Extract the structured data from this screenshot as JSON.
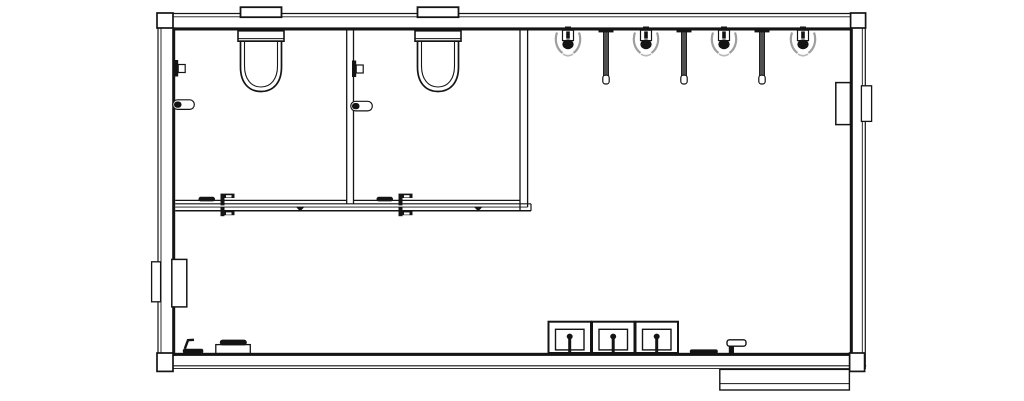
{
  "canvas": {
    "width": 1024,
    "height": 401,
    "background": "#ffffff",
    "ink": "#141414"
  },
  "layers": [
    {
      "name": "exterior-shell",
      "items": [
        {
          "name": "wall-top",
          "shapes": [
            {
              "t": "line",
              "x1": 157.2,
              "y1": 13.5,
              "x2": 866.2,
              "y2": 13.5,
              "sw": 1.2
            },
            {
              "t": "line",
              "x1": 158,
              "y1": 16.8,
              "x2": 865.4,
              "y2": 16.8,
              "sw": 0.9
            },
            {
              "t": "rect",
              "x": 173,
              "y": 27.4,
              "w": 677,
              "h": 3.1,
              "f": "#141414",
              "s": "none"
            }
          ]
        },
        {
          "name": "wall-bottom",
          "shapes": [
            {
              "t": "rect",
              "x": 173,
              "y": 352.8,
              "w": 677,
              "h": 3.1,
              "f": "#141414",
              "s": "none"
            },
            {
              "t": "line",
              "x1": 157.2,
              "y1": 365.8,
              "x2": 866.2,
              "y2": 365.8,
              "sw": 1.2
            },
            {
              "t": "line",
              "x1": 158,
              "y1": 368.6,
              "x2": 865.4,
              "y2": 368.6,
              "sw": 0.9
            }
          ]
        },
        {
          "name": "wall-left",
          "shapes": [
            {
              "t": "line",
              "x1": 158,
              "y1": 13.5,
              "x2": 158,
              "y2": 369,
              "sw": 1.2
            },
            {
              "t": "line",
              "x1": 161,
              "y1": 13.5,
              "x2": 161,
              "y2": 369,
              "sw": 0.9
            },
            {
              "t": "rect",
              "x": 172.2,
              "y": 27.4,
              "w": 3,
              "h": 328.5,
              "f": "#141414",
              "s": "none"
            }
          ]
        },
        {
          "name": "wall-right",
          "shapes": [
            {
              "t": "rect",
              "x": 849.8,
              "y": 27.4,
              "w": 3,
              "h": 328.5,
              "f": "#141414",
              "s": "none"
            },
            {
              "t": "line",
              "x1": 862.3,
              "y1": 13.5,
              "x2": 862.3,
              "y2": 369,
              "sw": 0.9
            },
            {
              "t": "line",
              "x1": 865.3,
              "y1": 13.5,
              "x2": 865.3,
              "y2": 369,
              "sw": 1.2
            }
          ]
        },
        {
          "name": "corner-post-top-left",
          "shapes": [
            {
              "t": "rect",
              "x": 157,
              "y": 13,
              "w": 16,
              "h": 15,
              "sw": 1.7,
              "f": "#ffffff"
            }
          ]
        },
        {
          "name": "corner-post-top-right",
          "shapes": [
            {
              "t": "rect",
              "x": 850.6,
              "y": 13,
              "w": 15,
              "h": 15,
              "sw": 1.7,
              "f": "#ffffff"
            }
          ]
        },
        {
          "name": "corner-post-bottom-left",
          "shapes": [
            {
              "t": "rect",
              "x": 157,
              "y": 353,
              "w": 16,
              "h": 18.4,
              "sw": 1.7,
              "f": "#ffffff"
            }
          ]
        },
        {
          "name": "corner-post-bottom-right",
          "shapes": [
            {
              "t": "rect",
              "x": 849.6,
              "y": 353,
              "w": 15,
              "h": 18.4,
              "sw": 1.7,
              "f": "#ffffff"
            }
          ]
        },
        {
          "name": "entry-landing",
          "shapes": [
            {
              "t": "rect",
              "x": 719.8,
              "y": 369.4,
              "w": 129.6,
              "h": 20.6,
              "sw": 1.4,
              "f": "#ffffff"
            },
            {
              "t": "line",
              "x1": 719.8,
              "y1": 383.6,
              "x2": 849.4,
              "y2": 383.6,
              "sw": 1
            }
          ]
        }
      ]
    },
    {
      "name": "stall-partitions",
      "items": [
        {
          "name": "stall-partition-mid",
          "shapes": [
            {
              "t": "line",
              "x1": 346.7,
              "y1": 30.5,
              "x2": 346.7,
              "y2": 203.6,
              "sw": 1.3
            },
            {
              "t": "line",
              "x1": 353.5,
              "y1": 30.5,
              "x2": 353.5,
              "y2": 203.6,
              "sw": 1.3
            }
          ]
        },
        {
          "name": "stall-side-wall-right",
          "shapes": [
            {
              "t": "line",
              "x1": 520,
              "y1": 30.5,
              "x2": 520,
              "y2": 210.8,
              "sw": 1.3
            },
            {
              "t": "line",
              "x1": 527.6,
              "y1": 30.5,
              "x2": 527.6,
              "y2": 207.1,
              "sw": 1.3
            }
          ]
        },
        {
          "name": "stall-front-wall",
          "shapes": [
            {
              "t": "line",
              "x1": 175.2,
              "y1": 200.4,
              "x2": 346.7,
              "y2": 200.4,
              "sw": 1.2
            },
            {
              "t": "line",
              "x1": 353.5,
              "y1": 200.4,
              "x2": 520,
              "y2": 200.4,
              "sw": 1.2
            },
            {
              "t": "line",
              "x1": 175.2,
              "y1": 203.8,
              "x2": 531,
              "y2": 203.8,
              "sw": 1.2
            },
            {
              "t": "line",
              "x1": 175.2,
              "y1": 207.1,
              "x2": 527.6,
              "y2": 207.1,
              "sw": 0.9
            },
            {
              "t": "line",
              "x1": 175.2,
              "y1": 210.8,
              "x2": 531,
              "y2": 210.8,
              "sw": 1.5
            },
            {
              "t": "line",
              "x1": 531,
              "y1": 203.8,
              "x2": 531,
              "y2": 210.8,
              "sw": 1.2
            }
          ]
        }
      ]
    },
    {
      "name": "fixtures",
      "items": [
        {
          "name": "toilet",
          "instances": [
            {
              "x": 261,
              "y": 0
            },
            {
              "x": 438,
              "y": 0
            }
          ],
          "shapes": [
            {
              "t": "rect",
              "x": -20.5,
              "y": 7.2,
              "w": 41,
              "h": 10,
              "sw": 1.8,
              "f": "#ffffff"
            },
            {
              "t": "rect",
              "x": -23,
              "y": 30.8,
              "w": 46,
              "h": 10.4,
              "sw": 1.6,
              "f": "#ffffff"
            },
            {
              "t": "line",
              "x1": -23,
              "y1": 38.6,
              "x2": 23,
              "y2": 38.6,
              "sw": 1
            },
            {
              "t": "path",
              "d": "M -20.5 41.2 L -20.5 67 C -20.5 83 -12 91.5 0 91.5 C 12 91.5 20.5 83 20.5 67 L 20.5 41.2 Z",
              "sw": 1.7,
              "f": "#ffffff"
            },
            {
              "t": "path",
              "d": "M -16.5 41.2 L -16.5 66 C -16.5 79.5 -9.5 87 0 87 C 9.5 87 16.5 79.5 16.5 66 L 16.5 41.2",
              "sw": 1.1
            }
          ]
        },
        {
          "name": "urinal",
          "instances": [
            {
              "x": 568,
              "y": 0
            },
            {
              "x": 646,
              "y": 0
            },
            {
              "x": 724,
              "y": 0
            },
            {
              "x": 803,
              "y": 0
            }
          ],
          "shapes": [
            {
              "t": "path",
              "d": "M -11 32.5 C -14 41 -11 49 -5.5 53",
              "s": "#9e9e9e",
              "sw": 2.2
            },
            {
              "t": "path",
              "d": "M 11 32.5 C 14 41 11 49 5.5 53",
              "s": "#9e9e9e",
              "sw": 2.2
            },
            {
              "t": "path",
              "d": "M -5 54 Q 0 57.5 5 54",
              "s": "#b8b8b8",
              "sw": 1.6
            },
            {
              "t": "rect",
              "x": -3,
              "y": 26.5,
              "w": 6,
              "h": 5,
              "f": "#141414",
              "s": "none"
            },
            {
              "t": "rect",
              "x": -5.5,
              "y": 30.2,
              "w": 11,
              "h": 10.4,
              "sw": 1.2,
              "f": "#ffffff"
            },
            {
              "t": "rect",
              "x": -1.8,
              "y": 31.4,
              "w": 3.6,
              "h": 7.2,
              "f": "#141414",
              "s": "none"
            },
            {
              "t": "ellipse",
              "cx": 0,
              "cy": 44.3,
              "rx": 5.6,
              "ry": 4.9,
              "f": "#141414",
              "s": "none"
            }
          ]
        },
        {
          "name": "urinal-privacy-screen",
          "instances": [
            {
              "x": 606,
              "y": 0
            },
            {
              "x": 684,
              "y": 0
            },
            {
              "x": 762,
              "y": 0
            }
          ],
          "shapes": [
            {
              "t": "rect",
              "x": -7.5,
              "y": 28.6,
              "w": 15,
              "h": 3.8,
              "f": "#141414",
              "s": "none"
            },
            {
              "t": "rect",
              "x": -2.6,
              "y": 32,
              "w": 5.2,
              "h": 45,
              "f": "#4f4f4f",
              "sw": 0.8
            },
            {
              "t": "rect",
              "x": -3.2,
              "y": 75.2,
              "w": 6.4,
              "h": 8.8,
              "rx": 2.6,
              "f": "#ffffff",
              "sw": 1.2
            }
          ]
        },
        {
          "name": "sink",
          "instances": [
            {
              "x": 548.5,
              "y": 321.7
            },
            {
              "x": 592,
              "y": 321.7
            },
            {
              "x": 635.5,
              "y": 321.7
            }
          ],
          "shapes": [
            {
              "t": "rect",
              "x": 0,
              "y": 0,
              "w": 42.5,
              "h": 31.3,
              "sw": 2,
              "f": "#ffffff"
            },
            {
              "t": "rect",
              "x": 7,
              "y": 7.6,
              "w": 28.5,
              "h": 20.6,
              "sw": 1.4
            },
            {
              "t": "rect",
              "x": 19.7,
              "y": 13.4,
              "w": 3,
              "h": 17.9,
              "f": "#141414",
              "s": "none"
            },
            {
              "t": "ellipse",
              "cx": 21.2,
              "cy": 14.8,
              "rx": 3,
              "ry": 2.9,
              "f": "#141414",
              "s": "none"
            }
          ]
        },
        {
          "name": "coat-hook",
          "instances": [
            {
              "x": 174,
              "y": 60
            },
            {
              "x": 352,
              "y": 60.5
            }
          ],
          "shapes": [
            {
              "t": "rect",
              "x": 0,
              "y": 0,
              "w": 4.2,
              "h": 16.5,
              "f": "#141414",
              "s": "none"
            },
            {
              "t": "rect",
              "x": 4.2,
              "y": 4.5,
              "w": 7,
              "h": 8,
              "sw": 1.2,
              "f": "#ffffff"
            }
          ]
        },
        {
          "name": "toilet-paper-dispenser",
          "instances": [
            {
              "x": 172.8,
              "y": 99.8
            },
            {
              "x": 350.8,
              "y": 101.3
            }
          ],
          "shapes": [
            {
              "t": "rect",
              "x": 0,
              "y": 0,
              "w": 21.5,
              "h": 9.6,
              "rx": 4.6,
              "sw": 1.2,
              "f": "#ffffff"
            },
            {
              "t": "rect",
              "x": 1.2,
              "y": 1.7,
              "w": 7.5,
              "h": 6.2,
              "rx": 3,
              "f": "#141414",
              "s": "none"
            }
          ]
        },
        {
          "name": "stall-door-hardware",
          "instances": [
            {
              "x": 198.5,
              "y": 196.8
            },
            {
              "x": 376.5,
              "y": 196.8
            }
          ],
          "shapes": [
            {
              "t": "rect",
              "x": 0,
              "y": 0,
              "w": 16.5,
              "h": 4.6,
              "rx": 2.2,
              "f": "#141414",
              "s": "none"
            },
            {
              "t": "rect",
              "x": 22,
              "y": -3.2,
              "w": 14,
              "h": 4.4,
              "f": "#141414",
              "s": "none"
            },
            {
              "t": "rect",
              "x": 27.5,
              "y": -1.6,
              "w": 5.5,
              "h": 2.2,
              "f": "#ffffff",
              "s": "none"
            },
            {
              "t": "rect",
              "x": 22,
              "y": -0.8,
              "w": 4,
              "h": 9.4,
              "f": "#141414",
              "s": "none"
            },
            {
              "t": "rect",
              "x": 22,
              "y": 14,
              "w": 14,
              "h": 4.4,
              "f": "#141414",
              "s": "none"
            },
            {
              "t": "rect",
              "x": 27.5,
              "y": 15.6,
              "w": 5.5,
              "h": 2.2,
              "f": "#ffffff",
              "s": "none"
            },
            {
              "t": "rect",
              "x": 22,
              "y": 10.7,
              "w": 4,
              "h": 8.7,
              "f": "#141414",
              "s": "none"
            },
            {
              "t": "polygon",
              "p": "97.3,10 106.1,10 101.7,14.6",
              "f": "#141414",
              "s": "none"
            }
          ]
        },
        {
          "name": "door-handle-left",
          "instances": [
            {
              "x": 182.8,
              "y": 348.8
            }
          ],
          "shapes": [
            {
              "t": "path",
              "d": "M 11.2 -9 L 5.2 -8.6 L 2 0",
              "sw": 2.4
            },
            {
              "t": "rect",
              "x": 0,
              "y": 0,
              "w": 20.5,
              "h": 4.6,
              "rx": 2,
              "f": "#141414",
              "s": "none"
            }
          ]
        },
        {
          "name": "floor-fixture-left",
          "instances": [
            {
              "x": 215.8,
              "y": 339.6
            }
          ],
          "shapes": [
            {
              "t": "rect",
              "x": 0,
              "y": 5,
              "w": 34.5,
              "h": 8.8,
              "sw": 1.3,
              "f": "#ffffff"
            },
            {
              "t": "rect",
              "x": 4,
              "y": 0,
              "w": 27,
              "h": 5.8,
              "rx": 2.8,
              "f": "#141414",
              "s": "none"
            }
          ]
        },
        {
          "name": "door-handle-right",
          "instances": [
            {
              "x": 689.8,
              "y": 339.8
            }
          ],
          "shapes": [
            {
              "t": "rect",
              "x": 0,
              "y": 9.6,
              "w": 28,
              "h": 4.4,
              "rx": 2,
              "f": "#141414",
              "s": "none"
            },
            {
              "t": "rect",
              "x": 37.2,
              "y": 0,
              "w": 19,
              "h": 6.4,
              "rx": 2.4,
              "sw": 1.4,
              "f": "#ffffff"
            },
            {
              "t": "rect",
              "x": 39,
              "y": 6.4,
              "w": 5.2,
              "h": 8.2,
              "f": "#141414",
              "s": "none"
            }
          ]
        },
        {
          "name": "recessed-wall-unit-left",
          "instances": [
            {
              "x": 151.6,
              "y": 259.4
            }
          ],
          "shapes": [
            {
              "t": "rect",
              "x": 0,
              "y": 2.4,
              "w": 9,
              "h": 40,
              "sw": 1.3,
              "f": "#ffffff"
            },
            {
              "t": "rect",
              "x": 20.2,
              "y": 0,
              "w": 15,
              "h": 47.5,
              "sw": 1.5,
              "f": "#ffffff"
            }
          ]
        },
        {
          "name": "recessed-wall-unit-right",
          "instances": [
            {
              "x": 835.8,
              "y": 82.6
            }
          ],
          "shapes": [
            {
              "t": "rect",
              "x": 0,
              "y": 0,
              "w": 14.6,
              "h": 42,
              "sw": 1.5,
              "f": "#ffffff"
            },
            {
              "t": "rect",
              "x": 25.6,
              "y": 3.2,
              "w": 10.2,
              "h": 35.6,
              "sw": 1.3,
              "f": "#ffffff"
            }
          ]
        }
      ]
    }
  ]
}
